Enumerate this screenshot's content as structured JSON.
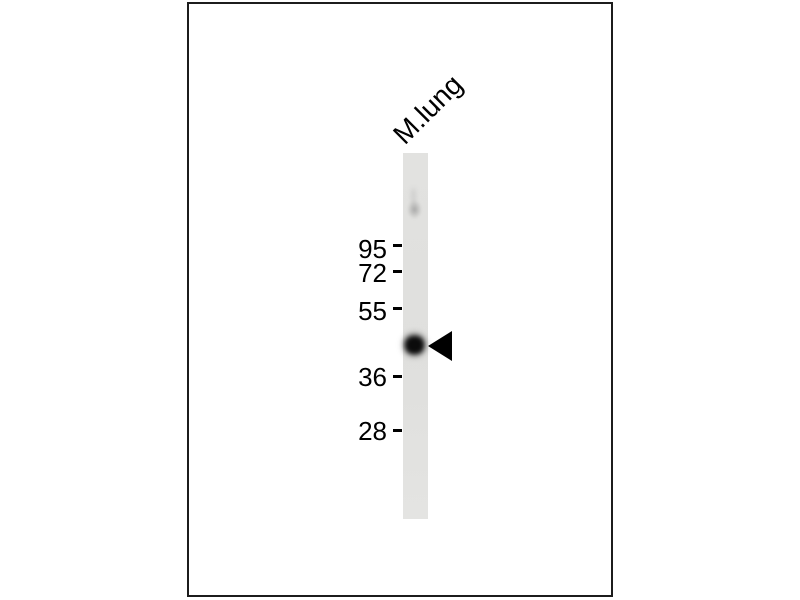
{
  "lane": {
    "label": "M.lung"
  },
  "markers": [
    {
      "label": "95"
    },
    {
      "label": "72"
    },
    {
      "label": "55"
    },
    {
      "label": "36"
    },
    {
      "label": "28"
    }
  ],
  "icons": {
    "band_arrow": "left-pointing-triangle"
  },
  "colors": {
    "background": "#ffffff",
    "frame_border": "#1c1c1c",
    "lane_fill": "#e2e2e0",
    "band": "#0b0b0b",
    "arrow": "#000000",
    "text": "#000000"
  }
}
